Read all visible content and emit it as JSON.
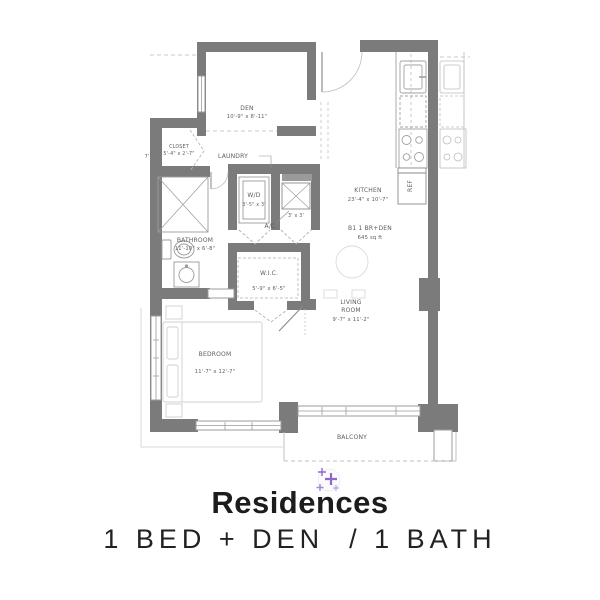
{
  "plan": {
    "rooms": {
      "den": {
        "label": "DEN",
        "dims": "10'-9\" x 8'-11\""
      },
      "closet": {
        "label": "CLOSET",
        "dims": "5'-4\" x 2'-7\""
      },
      "laundry": {
        "label": "LAUNDRY"
      },
      "wd": {
        "label": "W/D",
        "dims": "3'-5\" x 3'"
      },
      "ac": {
        "label": "A/C",
        "dims": "3' x 3'"
      },
      "kitchen": {
        "label": "KITCHEN",
        "dims": "23'-4\" x 10'-7\""
      },
      "bathroom": {
        "label": "BATHROOM",
        "dims": "11'-10\" x 6'-8\""
      },
      "wic": {
        "label": "W.I.C.",
        "dims": "5'-9\" x 6'-5\""
      },
      "living": {
        "label1": "LIVING",
        "label2": "ROOM",
        "dims": "9'-7\" x 11'-2\""
      },
      "bedroom": {
        "label": "BEDROOM",
        "dims": "11'-7\" x 12'-7\""
      },
      "balcony": {
        "label": "BALCONY"
      },
      "ref": {
        "label": "REF"
      }
    },
    "unit": {
      "line1": "B1  1 BR+DEN",
      "line2": "645 sq ft"
    },
    "note_7ft": "7'"
  },
  "footer": {
    "title": "Residences",
    "subtitle": "1 BED + DEN  / 1 BATH"
  },
  "colors": {
    "wall": "#7b7b7b",
    "fixture_line": "#9b9b9b",
    "faint_line": "#cfcfcf",
    "label_text": "#5d5d5d",
    "title_text": "#1c1c1c",
    "marker_purple": "#8d68c8"
  }
}
